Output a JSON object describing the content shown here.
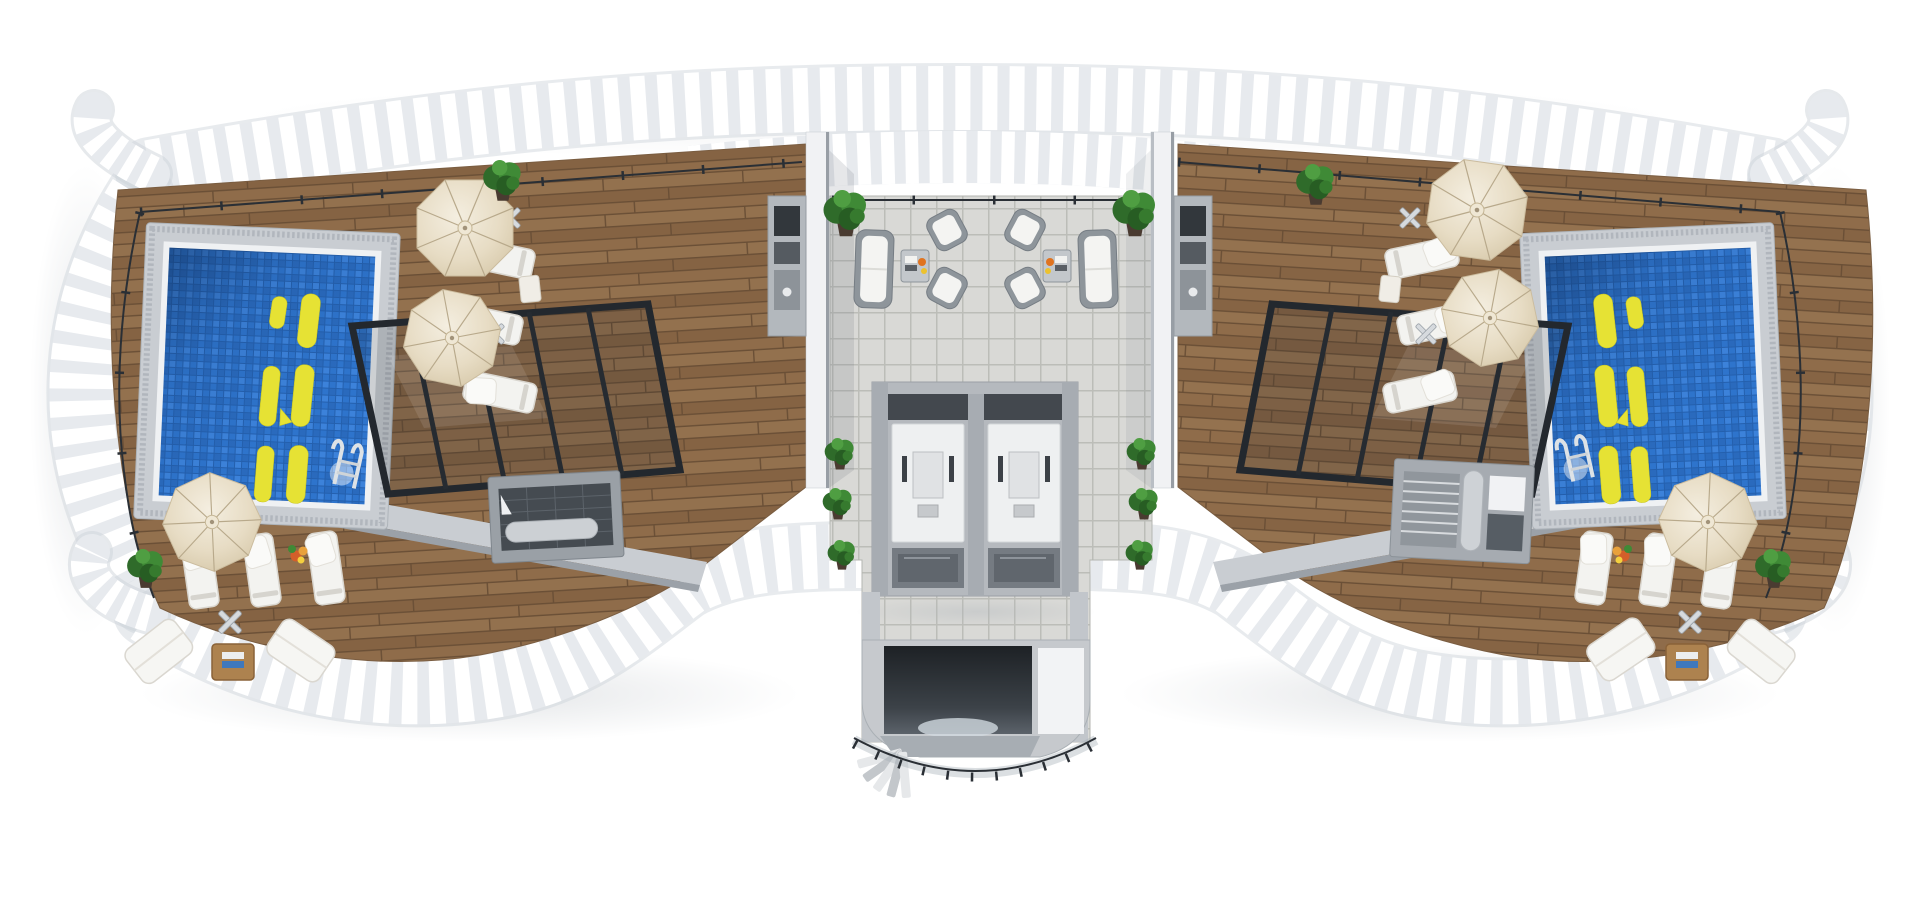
{
  "scene": {
    "title": "3D rooftop terrace floor plan, top-down view",
    "kind": "architectural 3d render",
    "aria_label": "Top-down 3D rendering of a symmetric rooftop pool terrace: two blue mosaic pools with yellow tile numerals, wooden plank decks with beige umbrellas and white sun loungers, a white slatted scroll-cornered parapet around the perimeter, and a central grey-tiled court with wicker lounge sets, two elevators and a curved glass-railed stairwell",
    "background_color": "#ffffff"
  },
  "palette": {
    "fence_slat": "#ffffff",
    "fence_gap": "#e7eaee",
    "wood": "#8d6b49",
    "wood_seam": "#6a4f36",
    "pool_water": "#2e74cc",
    "pool_coping": "#c9cdd2",
    "pool_marking": "#e6e234",
    "court_tile": "#d9d9d6",
    "tile_grout": "#bcbdb8",
    "wall": "#f1f2f4",
    "wall_shade": "#989ea5",
    "pergola_frame": "#262b31",
    "umbrella": "#e9dfca",
    "cushion_white": "#f4f4f2",
    "wicker_grey": "#8e959b",
    "plant_green": "#3f8a36",
    "elevator_car": "#eef0f1",
    "elevator_door": "#757b82",
    "stair_void": "#22262b",
    "balustrade": "#2a2f35"
  },
  "perimeter_railing": {
    "style": "white slatted parapet with scrolled corners",
    "corner_scrolls": 4,
    "bands": [
      "top",
      "left",
      "right",
      "bottom-left",
      "bottom-right",
      "top-center-inner-row"
    ]
  },
  "left_wing": {
    "floor": "wood plank deck",
    "pool": {
      "shape": "rectangular, slightly rotated",
      "water": "blue mosaic tile",
      "coping": "grey stone border",
      "floor_marking": {
        "color": "#e6e234",
        "style": "stylized numeral tiles on pool floor"
      },
      "ladder_position": "bottom-right corner"
    },
    "umbrellas": 3,
    "sun_loungers": 6,
    "side_tables": 1,
    "parasol_bases": 3,
    "corner_set": {
      "sofas": 2,
      "coffee_table": 1,
      "books": [
        "white",
        "blue"
      ]
    },
    "pergola": "black-framed glass canopy",
    "bar_counter": 1,
    "kitchenette": 1,
    "plants": 3,
    "flower_pot": 1
  },
  "right_wing": {
    "floor": "wood plank deck",
    "pool": {
      "shape": "rectangular, slightly rotated",
      "water": "blue mosaic tile",
      "coping": "grey stone border",
      "floor_marking": {
        "color": "#e6e234",
        "style": "stylized numeral tiles on pool floor"
      },
      "ladder_position": "bottom-left corner"
    },
    "umbrellas": 3,
    "sun_loungers": 6,
    "side_tables": 1,
    "parasol_bases": 3,
    "corner_set": {
      "sofas": 2,
      "coffee_table": 1,
      "books": [
        "white",
        "blue"
      ]
    },
    "pergola": "black-framed glass canopy",
    "stair_room": 1,
    "kitchenette": 1,
    "plants": 3,
    "flower_pot": 1
  },
  "central_court": {
    "floor": "light grey ceramic tile grid",
    "lounge_sets": [
      {
        "position": "left",
        "sofa": 1,
        "armchairs": 2,
        "coffee_table": 1,
        "table_items": [
          "books",
          "fruit"
        ]
      },
      {
        "position": "right",
        "sofa": 1,
        "armchairs": 2,
        "coffee_table": 1,
        "table_items": [
          "books",
          "fruit"
        ]
      }
    ],
    "elevators": {
      "count": 2,
      "view": "open shafts, cabin tops visible",
      "doors_face": "court"
    },
    "stairwell": {
      "shape": "curved, bottom center",
      "balustrade": "glass with dark handrail",
      "dark_void": true
    },
    "planters": 8,
    "dividing_walls": 2
  }
}
